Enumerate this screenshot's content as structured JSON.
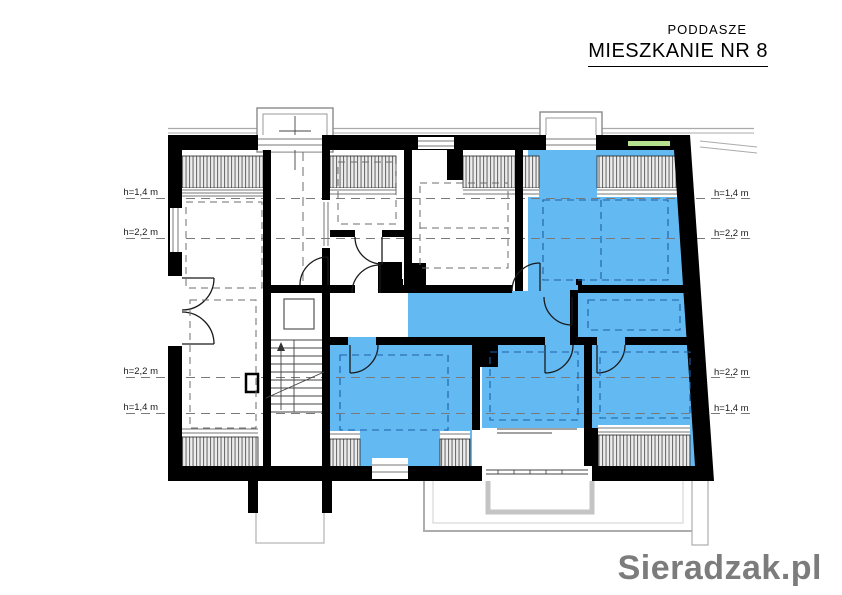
{
  "header": {
    "subtitle": "PODDASZE",
    "title": "MIESZKANIE NR 8"
  },
  "plan": {
    "left_height_labels": [
      "h=1,4 m",
      "h=2,2 m",
      "h=2,2 m",
      "h=1,4 m"
    ],
    "right_height_labels": [
      "h=1,4 m",
      "h=2,2 m",
      "h=2,2 m",
      "h=1,4 m"
    ],
    "colors": {
      "apartment_fill": "#63b9f2",
      "dashed_blue": "#1d5fa8",
      "wall_black": "#000000",
      "roof_gray": "#ababab",
      "accent_green": "#b5e08e"
    }
  },
  "watermark": {
    "text": "Sieradzak.pl",
    "color": "#7c7c7c"
  }
}
